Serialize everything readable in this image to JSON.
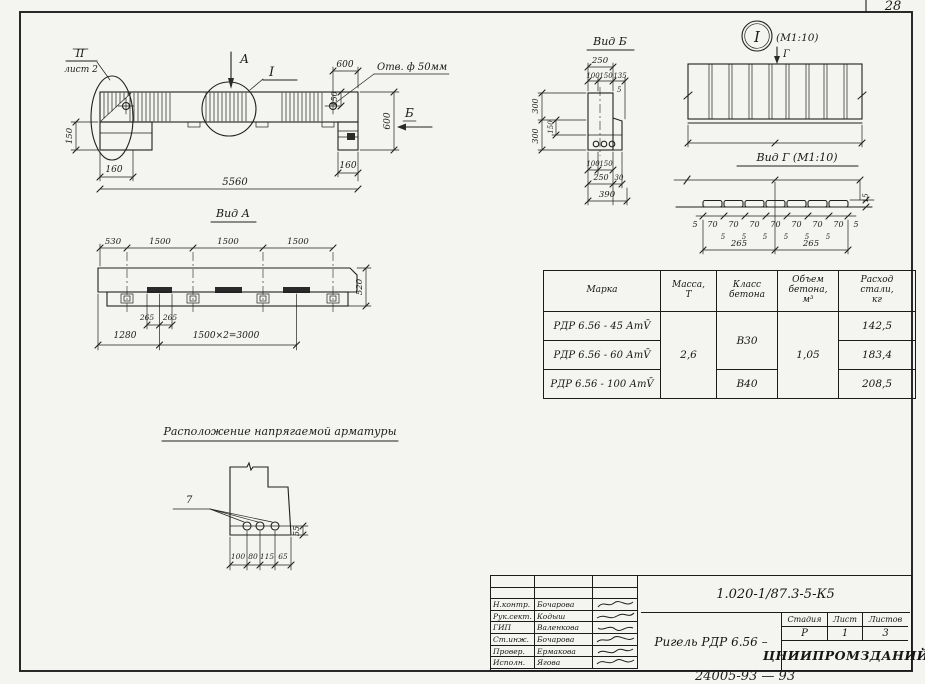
{
  "page_number": "28",
  "stamp_note": "24005-93 — 93",
  "elevation": {
    "callout_roman": "II",
    "callout_sheet": "лист 2",
    "arrow_a": "А",
    "detail_mark": "I",
    "arrow_b": "Б",
    "hole_note": "Отв. ф 50мм",
    "dim_hole_to_end": "600",
    "dim_hole_down": "150",
    "dim_height": "600",
    "dim_ledge": "150",
    "dim_left_end": "160",
    "dim_right_end": "160",
    "dim_length": "5560"
  },
  "view_a": {
    "title": "Вид А",
    "dim_530": "530",
    "dim_1500_1": "1500",
    "dim_1500_2": "1500",
    "dim_1500_3": "1500",
    "dim_265_1": "265",
    "dim_265_2": "265",
    "dim_1280": "1280",
    "dim_3000": "1500×2=3000",
    "dim_520": "520"
  },
  "view_b": {
    "title": "Вид Б",
    "dim_250_top": "250",
    "dim_100_top": "100",
    "dim_150_top": "150",
    "dim_135": "135",
    "dim_5": "5",
    "dim_300_top": "300",
    "dim_300_bot": "300",
    "dim_150_side": "150",
    "dim_100_bot": "100",
    "dim_150_bot": "150",
    "dim_250_bot": "250",
    "dim_30": "30",
    "dim_390": "390"
  },
  "detail_i": {
    "mark": "I",
    "scale": "(М1:10)",
    "arrow_g": "Г"
  },
  "view_g": {
    "title": "Вид Г (М1:10)",
    "dim_5_left": "5",
    "dim_5_right": "5",
    "dim_70": "70",
    "dim_5": "5",
    "dim_265_left": "265",
    "dim_265_right": "265",
    "dim_15": "15"
  },
  "rebar": {
    "title": "Расположение напрягаемой арматуры",
    "label_7": "7",
    "dim_100": "100",
    "dim_80": "80",
    "dim_115": "115",
    "dim_65": "65",
    "dim_55": "55"
  },
  "table": {
    "col_mark": "Марка",
    "col_mass": "Масса,\nТ",
    "col_class": "Класс\nбетона",
    "col_volume": "Объем\nбетона,\nм³",
    "col_steel": "Расход\nстали,\nкг",
    "mass": "2,6",
    "class_12": "В30",
    "class_3": "В40",
    "volume": "1,05",
    "rows": [
      {
        "mark": "РДР 6.56 - 45 АтV̄",
        "steel": "142,5"
      },
      {
        "mark": "РДР 6.56 - 60 АтV̄",
        "steel": "183,4"
      },
      {
        "mark": "РДР 6.56 - 100 АтV̄",
        "steel": "208,5"
      }
    ]
  },
  "title_block": {
    "doc_number": "1.020-1/87.3-5-К5",
    "title": "Ригель РДР 6.56 –",
    "stage_label": "Стадия",
    "sheet_label": "Лист",
    "sheets_label": "Листов",
    "stage": "Р",
    "sheet": "1",
    "sheets": "3",
    "organization": "ЦНИИПРОМЗДАНИЙ",
    "rows": [
      {
        "role": "Н.контр.",
        "name": "Бочарова"
      },
      {
        "role": "Рук.сект.",
        "name": "Кодыш"
      },
      {
        "role": "ГИП",
        "name": "Валенкова"
      },
      {
        "role": "Ст.инж.",
        "name": "Бочарова"
      },
      {
        "role": "Провер.",
        "name": "Ермакова"
      },
      {
        "role": "Исполн.",
        "name": "Ягова"
      }
    ]
  }
}
